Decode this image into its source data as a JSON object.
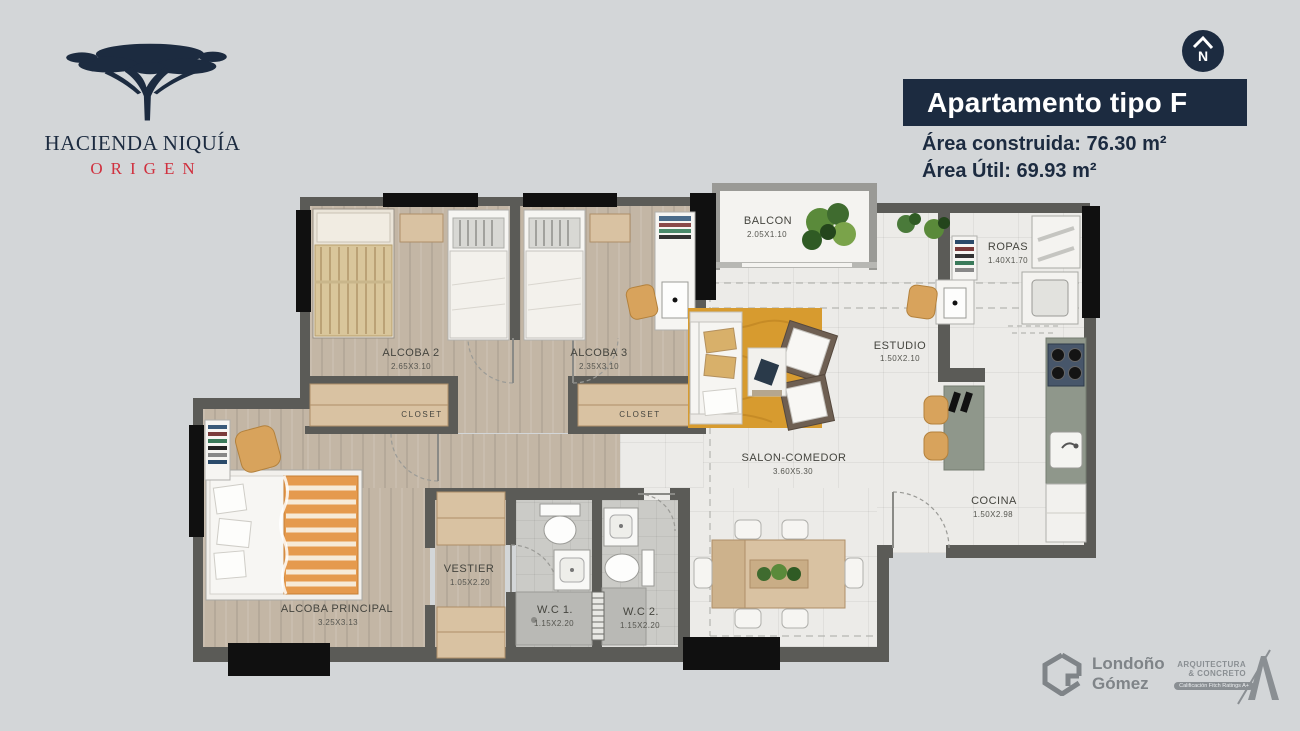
{
  "brand": {
    "title": "HACIENDA NIQUÍA",
    "subtitle": "ORIGEN"
  },
  "header": {
    "compass": "N",
    "title": "Apartamento tipo F",
    "area_line1": "Área construida: 76.30 m²",
    "area_line2": "Área Útil: 69.93 m²"
  },
  "plan": {
    "rooms": {
      "alcoba2": {
        "name": "ALCOBA 2",
        "dims": "2.65X3.10"
      },
      "alcoba3": {
        "name": "ALCOBA 3",
        "dims": "2.35X3.10"
      },
      "closet_a": {
        "name": "CLOSET"
      },
      "closet_b": {
        "name": "CLOSET"
      },
      "balcon": {
        "name": "BALCON",
        "dims": "2.05X1.10"
      },
      "ropas": {
        "name": "ROPAS",
        "dims": "1.40X1.70"
      },
      "estudio": {
        "name": "ESTUDIO",
        "dims": "1.50X2.10"
      },
      "salon": {
        "name": "SALON-COMEDOR",
        "dims": "3.60X5.30"
      },
      "cocina": {
        "name": "COCINA",
        "dims": "1.50X2.98"
      },
      "principal": {
        "name": "ALCOBA PRINCIPAL",
        "dims": "3.25X3.13"
      },
      "vestier": {
        "name": "VESTIER",
        "dims": "1.05X2.20"
      },
      "wc1": {
        "name": "W.C 1.",
        "dims": "1.15X2.20"
      },
      "wc2": {
        "name": "W.C 2.",
        "dims": "1.15X2.20"
      }
    }
  },
  "footer": {
    "developer_line1": "Londoño",
    "developer_line2": "Gómez",
    "builder_line1": "ARQUITECTURA",
    "builder_line2": "& CONCRETO",
    "builder_tagline": "Calificación Fitch Ratings A+"
  },
  "colors": {
    "navy": "#1c2b40",
    "red": "#d0313f",
    "wall": "#5b5b57",
    "rug": "#d79b2f",
    "wood": "#d9c2a2"
  }
}
